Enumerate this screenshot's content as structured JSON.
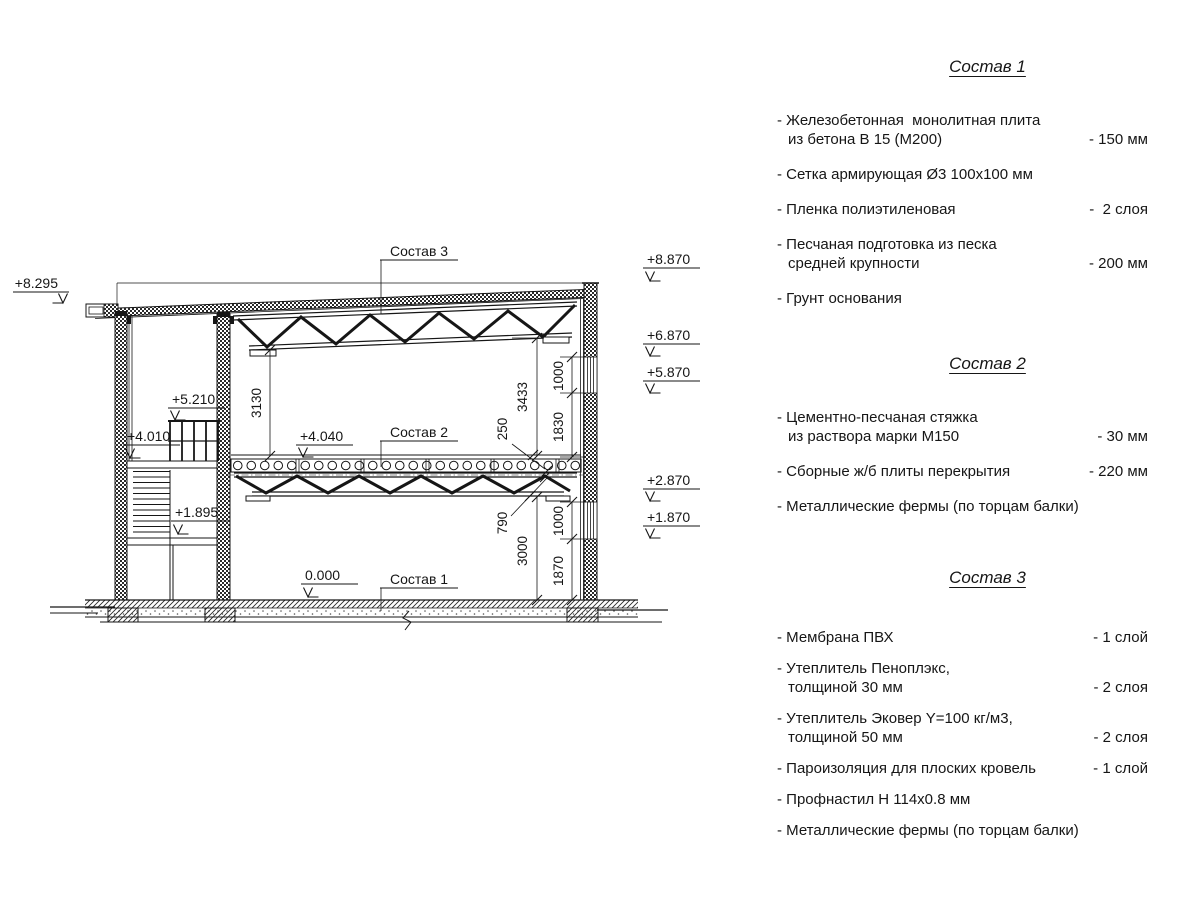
{
  "panels": [
    {
      "title": "Состав 1",
      "items": [
        {
          "lines": [
            "- Железобетонная  монолитная плита",
            "из бетона В 15 (М200)"
          ],
          "value": "- 150 мм"
        },
        {
          "lines": [
            "- Сетка армирующая Ø3 100x100 мм"
          ],
          "value": ""
        },
        {
          "lines": [
            "- Пленка полиэтиленовая"
          ],
          "value": "-  2 слоя"
        },
        {
          "lines": [
            "- Песчаная подготовка из песка",
            "средней крупности"
          ],
          "value": "- 200 мм"
        },
        {
          "lines": [
            "- Грунт основания"
          ],
          "value": ""
        }
      ]
    },
    {
      "title": "Состав 2",
      "items": [
        {
          "lines": [
            "- Цементно-песчаная стяжка",
            "из раствора марки М150"
          ],
          "value": "- 30 мм"
        },
        {
          "lines": [
            "- Сборные ж/б плиты перекрытия"
          ],
          "value": "- 220 мм"
        },
        {
          "lines": [
            "- Металлические фермы (по торцам балки)"
          ],
          "value": ""
        }
      ]
    },
    {
      "title": "Состав 3",
      "items": [
        {
          "lines": [
            "- Мембрана ПВХ"
          ],
          "value": "- 1 слой"
        },
        {
          "lines": [
            "- Утеплитель Пеноплэкс,",
            "толщиной 30 мм"
          ],
          "value": "- 2 слоя"
        },
        {
          "lines": [
            "- Утеплитель Эковер Y=100 кг/м3,",
            "толщиной 50 мм"
          ],
          "value": "- 2 слоя"
        },
        {
          "lines": [
            "- Пароизоляция для плоских кровель"
          ],
          "value": "- 1 слой"
        },
        {
          "lines": [
            "- Профнастил Н 114х0.8 мм"
          ],
          "value": ""
        },
        {
          "lines": [
            "- Металлические фермы (по торцам балки)"
          ],
          "value": ""
        }
      ]
    }
  ],
  "drawing": {
    "labels": {
      "sostav1": "Состав 1",
      "sostav2": "Состав 2",
      "sostav3": "Состав 3"
    },
    "elevations": {
      "e8295": "+8.295",
      "e8870": "+8.870",
      "e6870": "+6.870",
      "e5870": "+5.870",
      "e2870": "+2.870",
      "e1870": "+1.870",
      "e5210": "+5.210",
      "e4010": "+4.010",
      "e1895": "+1.895",
      "e4040": "+4.040",
      "e0000": "0.000"
    },
    "dims": {
      "d3130": "3130",
      "d3433": "3433",
      "d250": "250",
      "d1830": "1830",
      "d1000a": "1000",
      "d790": "790",
      "d3000": "3000",
      "d1870": "1870",
      "d1000b": "1000"
    },
    "colors": {
      "ink": "#161616",
      "paper": "#ffffff"
    }
  }
}
